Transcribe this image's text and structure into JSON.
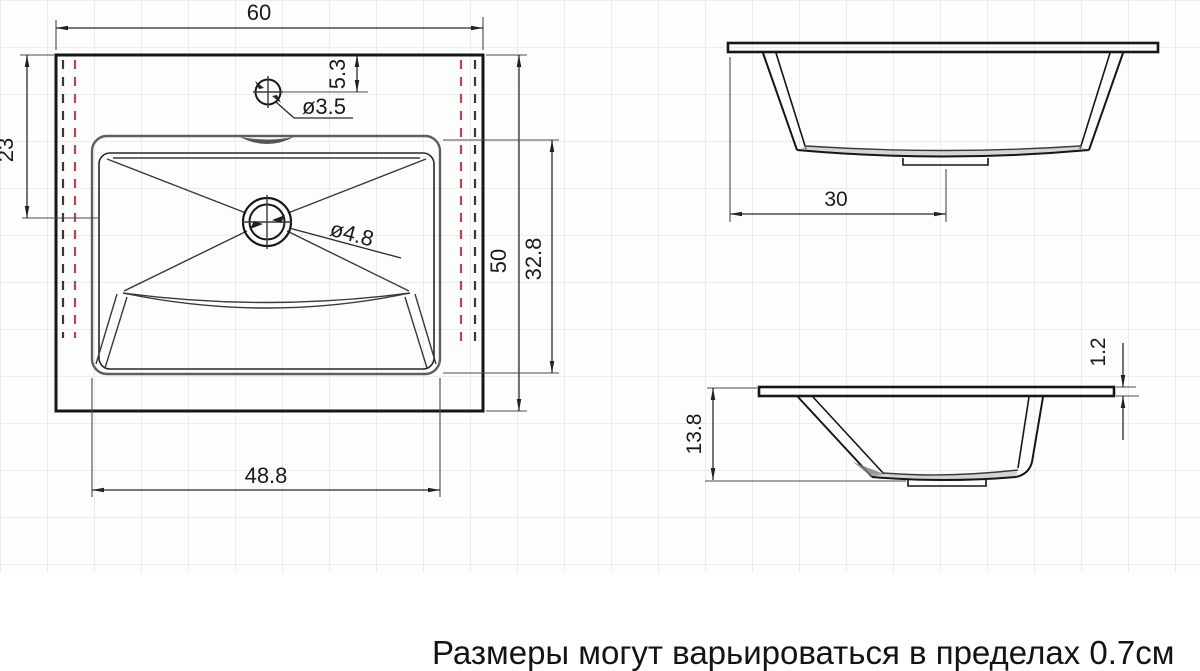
{
  "note": "Размеры могут варьироваться в пределах 0.7см",
  "top_view": {
    "overall_width": "60",
    "edge_to_drain_center": "23",
    "overall_depth": "50",
    "bowl_depth": "32.8",
    "bowl_width": "48.8",
    "faucet_offset": "5.3",
    "faucet_hole_diameter": "ø3.5",
    "drain_hole_diameter": "ø4.8"
  },
  "front_view": {
    "drain_center_offset": "30"
  },
  "side_view": {
    "total_height": "13.8",
    "rim_thickness": "1.2"
  },
  "colors": {
    "line": "#161616",
    "grid": "#c6c6c6",
    "dashed_inner": "#b5455c",
    "dashed_outer": "#463238",
    "shading": "#a8a8a8",
    "background": "#ffffff"
  }
}
